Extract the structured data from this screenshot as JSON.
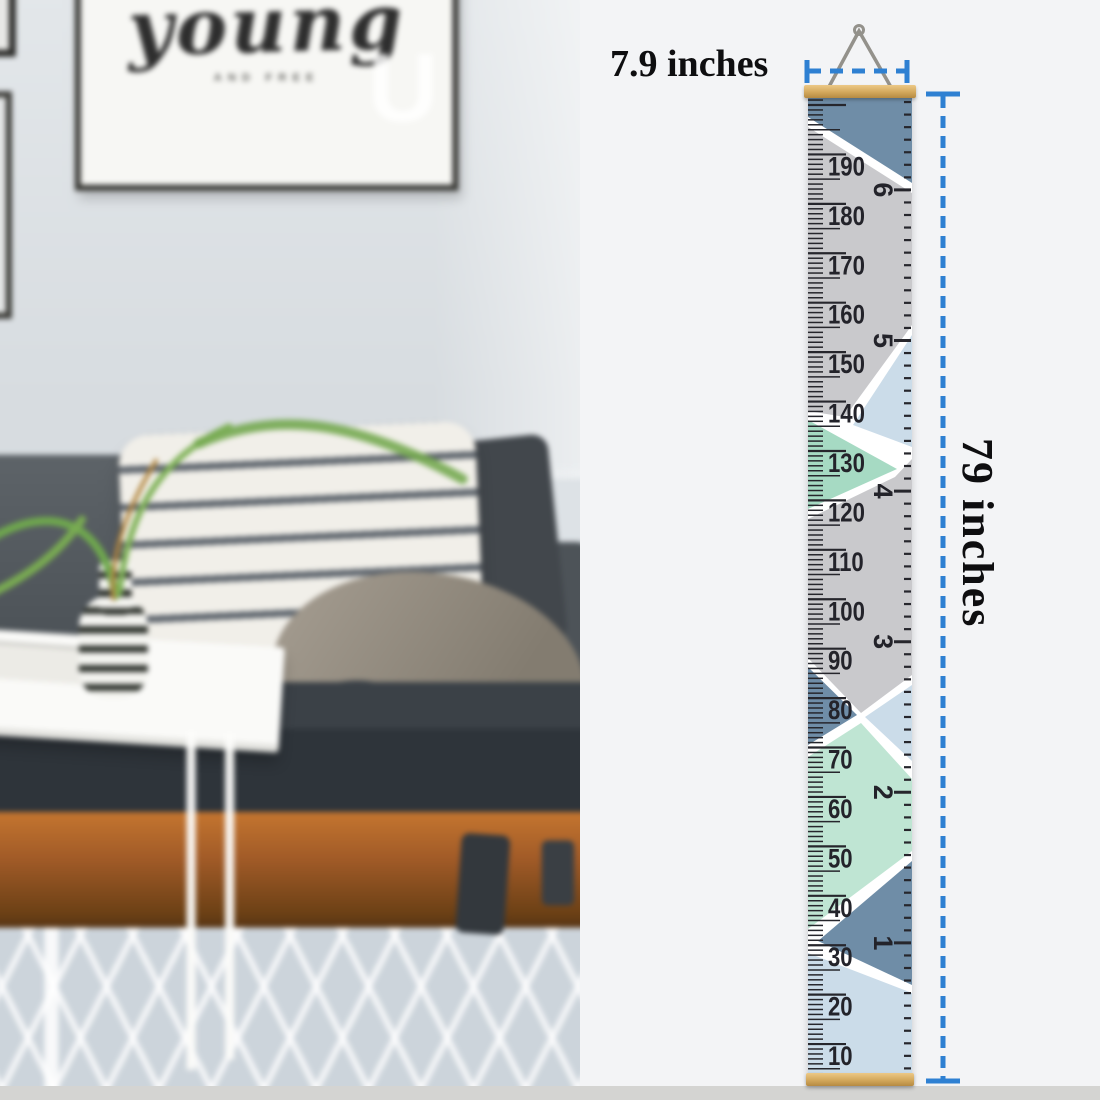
{
  "poster": {
    "title": "young",
    "subtitle": "AND FREE",
    "watermark_letter": "U"
  },
  "dimensions": {
    "width_label": "7.9 inches",
    "height_label": "79 inches"
  },
  "ruler": {
    "cm_labels": [
      10,
      20,
      30,
      40,
      50,
      60,
      70,
      80,
      90,
      100,
      110,
      120,
      130,
      140,
      150,
      160,
      170,
      180,
      190
    ],
    "feet_labels": [
      1,
      2,
      3,
      4,
      5,
      6
    ]
  },
  "colors": {
    "dim_line": "#2e80d2",
    "steel_blue": "#6f8da7",
    "light_gray": "#c9c9cc",
    "pale_blue": "#cbdce9",
    "mint_green": "#a6dac3",
    "mint_green_light": "#bfe5d3",
    "wood": "#d9ad66",
    "tick": "#26262c",
    "label": "#23232a",
    "strip": "#d4d4d2",
    "backdrop": "#f3f4f6",
    "rope": "#93918b"
  }
}
